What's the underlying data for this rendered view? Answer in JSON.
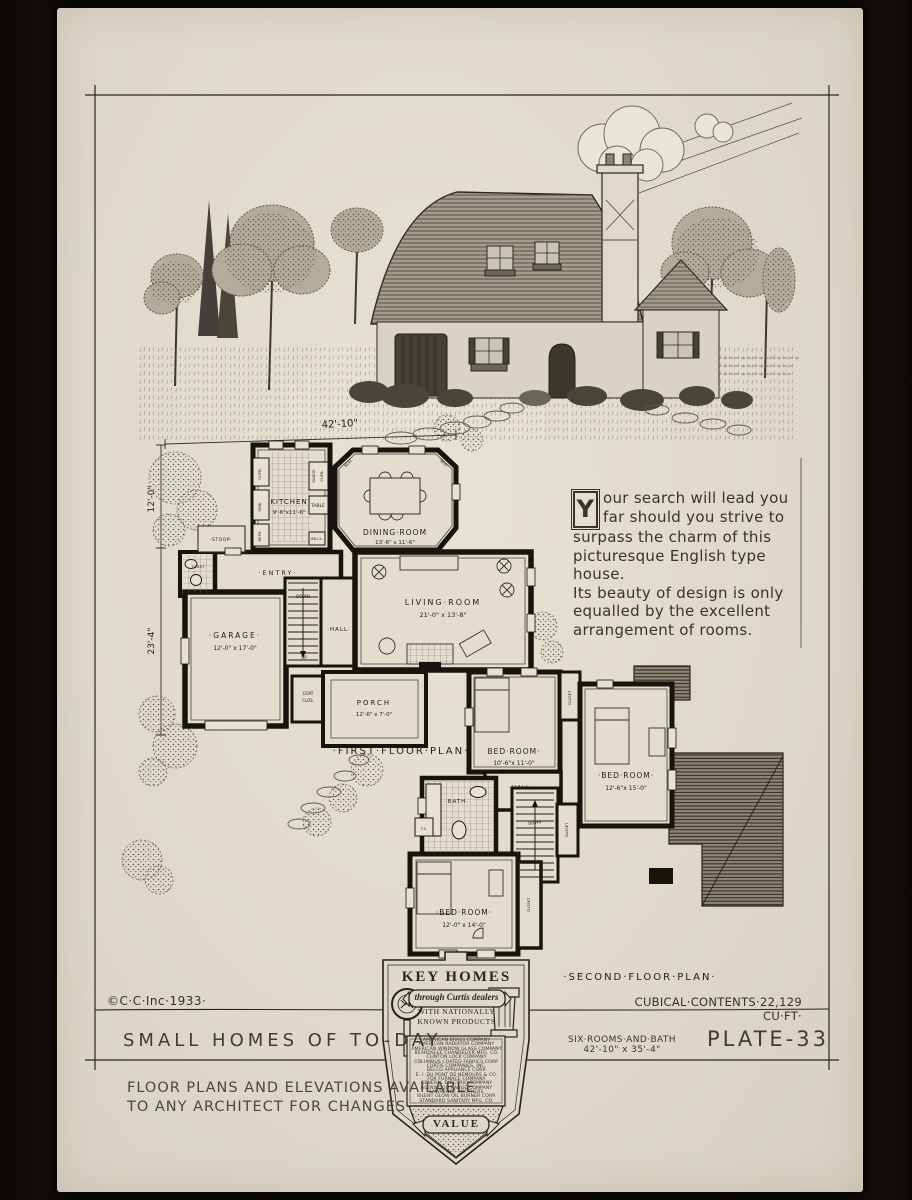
{
  "plate": {
    "copyright": "©C·C·Inc·1933·",
    "cubical_contents": "CUBICAL·CONTENTS·22,129 CU·FT·",
    "series_title": "SMALL HOMES OF TO-DAY",
    "rooms_line": "SIX·ROOMS·AND·BATH",
    "size_line": "42'-10\" x 35'-4\"",
    "plate_no": "PLATE-33",
    "note1": "FLOOR PLANS AND ELEVATIONS AVAILABLE",
    "note2": "TO ANY ARCHITECT FOR CHANGES"
  },
  "description": {
    "initial": "Y",
    "line1": "our search will lead you",
    "line2": "far should you strive to",
    "line3": "surpass the charm of this",
    "line4": "picturesque English type",
    "line5": "house.",
    "line6": "Its beauty of design is only",
    "line7": "equalled by the excellent",
    "line8": "arrangement of rooms."
  },
  "dimensions": {
    "width": "42'-10\"",
    "upper_left": "12'-0\"",
    "lower_left": "23'-4\""
  },
  "first_floor": {
    "title": "·FIRST·FLOOR·PLAN·",
    "kitchen": {
      "name": "KITCHEN",
      "size": "9'-6\"x11'-6\""
    },
    "dining": {
      "name": "DINING·ROOM",
      "size": "13'-6\" x 11'-6\""
    },
    "living": {
      "name": "LIVING·ROOM",
      "size": "21'-0\" x 13'-8\""
    },
    "garage": {
      "name": "·GARAGE·",
      "size": "12'-0\" x 17'-0\""
    },
    "porch": {
      "name": "PORCH",
      "size": "12'-6\" x 7'-0\""
    },
    "entry": "·ENTRY·",
    "hall": "·HALL·",
    "stoop": "·STOOP·",
    "toilet": "TOILET",
    "coat1": "COAT",
    "coat2": "CLOS.",
    "down": "DOWN",
    "up": "UP",
    "cupboard": "CUPB.",
    "sink": "SINK",
    "refrigerator": "REFR.",
    "range": "RANGE",
    "table": "TABLE",
    "seat": "SEAT",
    "broom_closet": "BR.CL."
  },
  "second_floor": {
    "title": "·SECOND·FLOOR·PLAN·",
    "bedroom1": {
      "name": "BED·ROOM·",
      "size": "10'-6\"x 11'-0\""
    },
    "bedroom2": {
      "name": "·BED·ROOM·",
      "size": "12'-6\"x 15'-0\""
    },
    "bedroom3": {
      "name": "·BED·ROOM·",
      "size": "12'-0\" x 14'-0\""
    },
    "bath": "·BATH·",
    "hall": "·HALL·",
    "down": "DOWN",
    "closet": "CLOSET",
    "toilet_closet": "T.C."
  },
  "badge": {
    "title": "KEY HOMES",
    "banner": "through Curtis dealers",
    "sub1": "WITH NATIONALLY",
    "sub2": "KNOWN PRODUCTS",
    "value": "VALUE",
    "companies": [
      "AMERICAN BRASS COMPANY",
      "AMERICAN RADIATOR COMPANY",
      "AMERICAN WINDOW GLASS COMPANY",
      "BEARDSLEE CHANDELIER MFG. CO.",
      "CLINTON LOCK COMPANY",
      "COLUMBUS COATED FABRICS CORP.",
      "CURTIS COMPANIES, INC.",
      "DELCO APPLIANCE CORP.",
      "E. I. DU PONT DE NEMOURS & CO.",
      "FOX FURNACE COMPANY",
      "GENERAL ELECTRIC COMPANY",
      "GLENWOOD RANGE COMPANY",
      "LAWRENCE BROTHERS",
      "SILENT GLOW OIL BURNER CORP.",
      "STANDARD SANITARY MFG. CO."
    ]
  }
}
